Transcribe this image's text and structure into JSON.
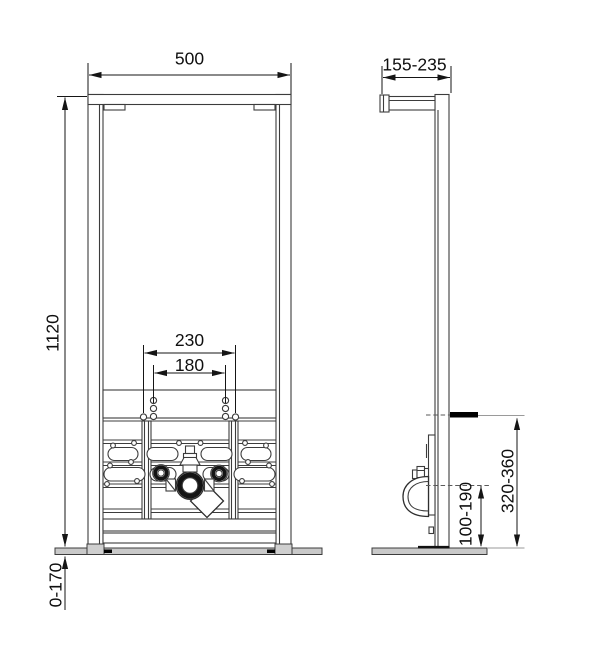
{
  "views": {
    "front": {
      "width": "500",
      "height": "1120",
      "anchor_outer": "230",
      "anchor_inner": "180",
      "foot_range": "0-170"
    },
    "side": {
      "depth": "155-235",
      "connection_height": "320-360",
      "drain_height": "100-190"
    }
  },
  "colors": {
    "floor_fill": "#c9c9c9",
    "mark_fill": "#000000",
    "line": "#3c3c3c",
    "dimension": "#151515"
  }
}
